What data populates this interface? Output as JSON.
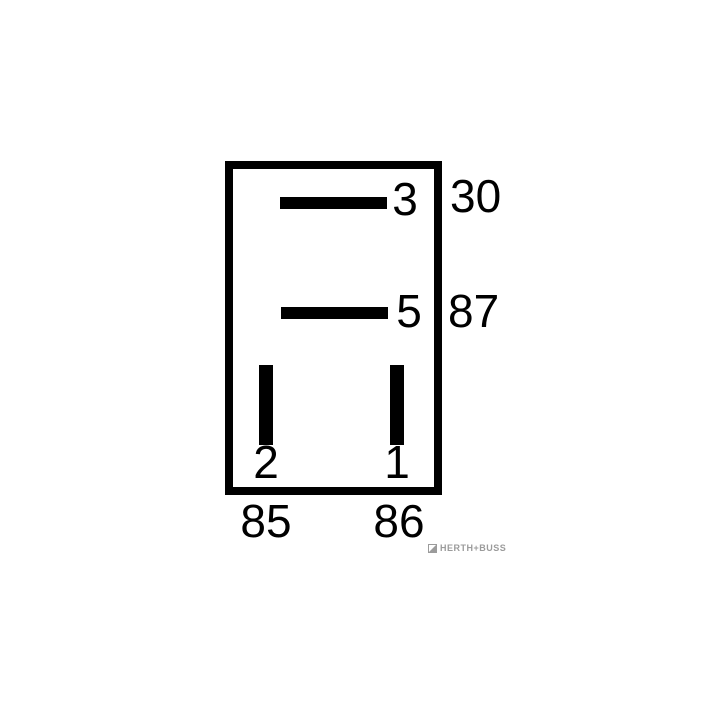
{
  "diagram": {
    "type": "relay-pinout",
    "colors": {
      "line": "#000000",
      "background": "#ffffff",
      "logo_gray": "#9b9b9b"
    },
    "pins": {
      "pin3": {
        "number": "3",
        "terminal": "30",
        "orientation": "horizontal",
        "position": "top-right-inside"
      },
      "pin5": {
        "number": "5",
        "terminal": "87",
        "orientation": "horizontal",
        "position": "middle-right-inside"
      },
      "pin2": {
        "number": "2",
        "terminal": "85",
        "orientation": "vertical",
        "position": "bottom-left-inside"
      },
      "pin1": {
        "number": "1",
        "terminal": "86",
        "orientation": "vertical",
        "position": "bottom-right-inside"
      }
    }
  },
  "logo": {
    "brand": "HERTH+BUSS"
  }
}
